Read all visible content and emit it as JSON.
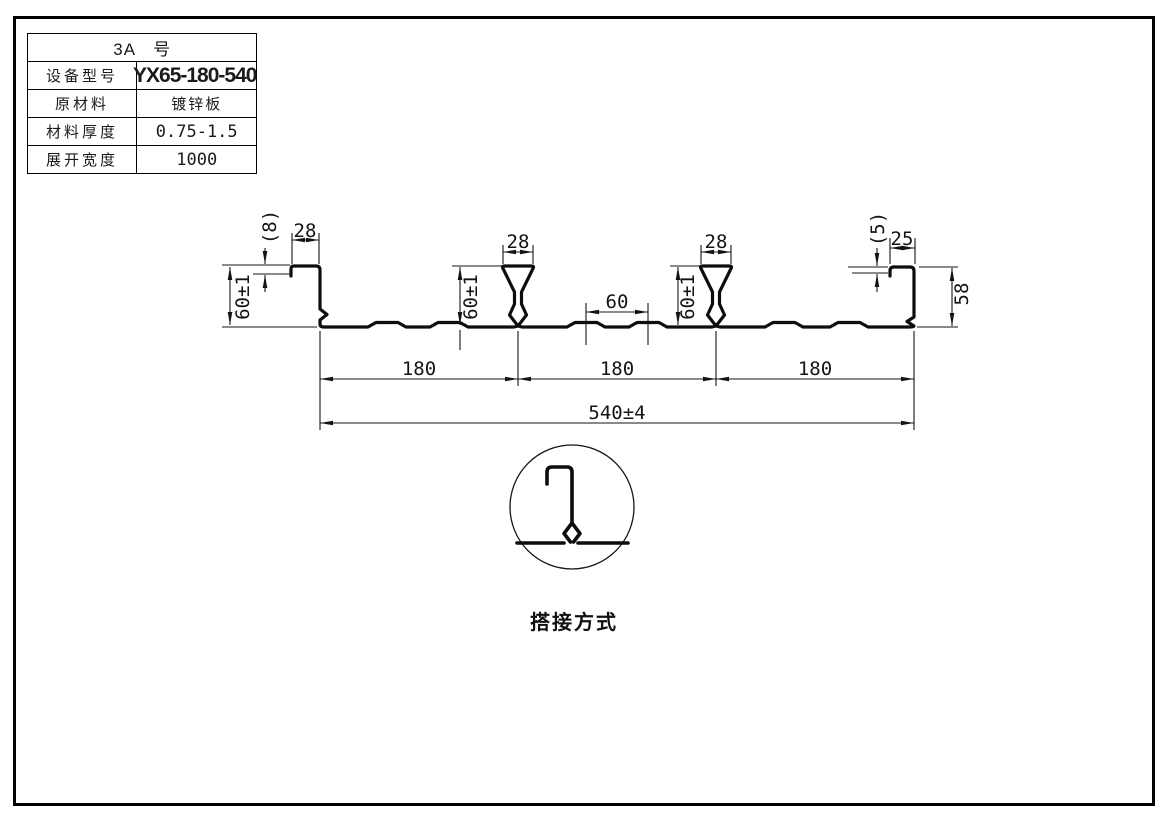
{
  "title_block": {
    "header": "3A　号",
    "rows": [
      {
        "label": "设备型号",
        "value": "YX65-180-540"
      },
      {
        "label": "原材料",
        "value": "镀锌板"
      },
      {
        "label": "材料厚度",
        "value": "0.75-1.5"
      },
      {
        "label": "展开宽度",
        "value": "1000"
      }
    ]
  },
  "drawing": {
    "dims": {
      "left_flange": "(8)",
      "left_lip": "28",
      "left_height": "60±1",
      "rib1_width": "28",
      "rib1_height": "60±1",
      "flute_pitch": "60",
      "rib2_width": "28",
      "rib2_height": "60±1",
      "right_flange": "(5)",
      "right_lip": "25",
      "right_height": "58",
      "span1": "180",
      "span2": "180",
      "span3": "180",
      "overall": "540±4"
    },
    "detail_caption": "搭接方式"
  }
}
